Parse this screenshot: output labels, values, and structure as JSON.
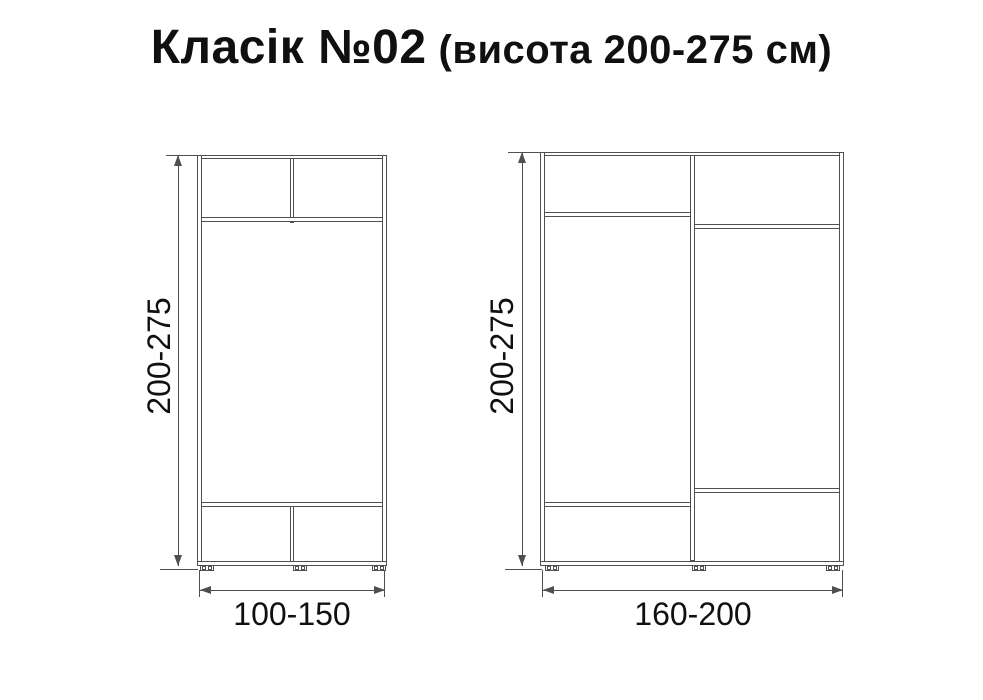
{
  "title": {
    "main": "Класік №02",
    "suffix": "(висота 200-275 см)"
  },
  "colors": {
    "line": "#4f4f4f",
    "text": "#101010",
    "background": "#ffffff"
  },
  "diagrams": [
    {
      "id": "wardrobe-small",
      "height_label": "200-275",
      "width_label": "100-150"
    },
    {
      "id": "wardrobe-large",
      "height_label": "200-275",
      "width_label": "160-200"
    }
  ]
}
